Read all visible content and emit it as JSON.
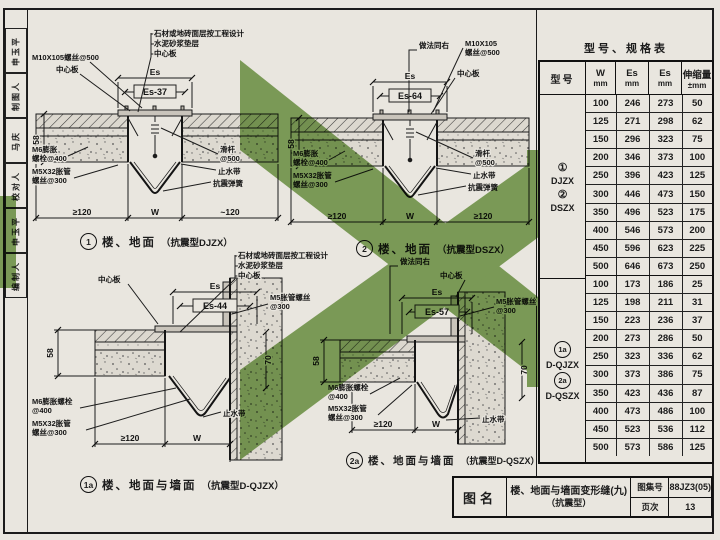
{
  "sheet": {
    "paper": "#e9e6df",
    "ink": "#1c1c1c",
    "green": "#85aa62"
  },
  "sidebar": {
    "cells": [
      "申玉平",
      "制图人",
      "马庆",
      "校对人",
      "申玉平",
      "编制人"
    ]
  },
  "details": {
    "d1": {
      "num": "1",
      "title": "楼、地面",
      "type": "（抗震型DJZX）",
      "es": "Es",
      "es_span": "Es-37",
      "depth": "58",
      "dim_left": "≥120",
      "dim_mid": "W",
      "dim_right": "~120",
      "note_m10": "M10X105螺丝@500",
      "note_center": "中心板",
      "layer1": "石材或地砖面层按工程设计",
      "layer2": "水泥砂浆垫层",
      "layer3": "中心板",
      "note_m6_1": "M6膨胀",
      "note_m6_2": "螺栓@400",
      "note_m5x_1": "M5X32胀管",
      "note_m5x_2": "螺丝@300",
      "note_rod_1": "滑杆",
      "note_rod_2": "@500",
      "note_stop": "止水带",
      "note_spring": "抗震弹簧"
    },
    "d2": {
      "num": "2",
      "title": "楼、地面",
      "type": "（抗震型DSZX）",
      "es": "Es",
      "es_span": "Es-64",
      "depth": "58",
      "dim_left": "≥120",
      "dim_mid": "W",
      "dim_right": "≥120",
      "note_same": "做法同右",
      "note_m10_1": "M10X105",
      "note_m10_2": "螺丝@500",
      "note_center": "中心板",
      "note_m6_1": "M6膨胀",
      "note_m6_2": "螺栓@400",
      "note_m5x_1": "M5X32胀管",
      "note_m5x_2": "螺丝@300",
      "note_rod_1": "滑杆",
      "note_rod_2": "@500",
      "note_stop": "止水带",
      "note_spring": "抗震弹簧"
    },
    "d1a": {
      "num": "1a",
      "title": "楼、地面与墙面",
      "type": "（抗震型D-QJZX）",
      "es": "Es",
      "es_span": "Es-44",
      "depth": "58",
      "wall_dim": "70",
      "dim_left": "≥120",
      "dim_mid": "W",
      "note_center": "中心板",
      "layer1": "石材或地砖面层按工程设计",
      "layer2": "水泥砂浆垫层",
      "layer3": "中心板",
      "note_m5_1": "M5胀管螺丝",
      "note_m5_2": "@300",
      "note_m6_1": "M6膨胀螺栓",
      "note_m6_2": "@400",
      "note_m5x_1": "M5X32胀管",
      "note_m5x_2": "螺丝@300",
      "note_stop": "止水带"
    },
    "d2a": {
      "num": "2a",
      "title": "楼、地面与墙面",
      "type": "（抗震型D-QSZX）",
      "es": "Es",
      "es_span": "Es-57",
      "depth": "58",
      "wall_dim": "70",
      "dim_left": "≥120",
      "dim_mid": "W",
      "note_same": "做法同右",
      "note_center": "中心板",
      "note_m5_1": "M5胀管螺丝",
      "note_m5_2": "@300",
      "note_m6_1": "M6膨胀螺栓",
      "note_m6_2": "@400",
      "note_m5x_1": "M5X32胀管",
      "note_m5x_2": "螺丝@300",
      "note_stop": "止水带"
    }
  },
  "spec_table": {
    "title": "型号、规格表",
    "headers": {
      "model": "型号",
      "w": "W",
      "w_unit": "mm",
      "es1": "Es",
      "es1_unit": "mm",
      "es2": "Es",
      "es2_unit": "mm",
      "range": "伸缩量",
      "range_unit": "±mm"
    },
    "group1": {
      "mark1": "①",
      "name1": "DJZX",
      "mark2": "②",
      "name2": "DSZX",
      "rows": [
        [
          "100",
          "246",
          "273",
          "50"
        ],
        [
          "125",
          "271",
          "298",
          "62"
        ],
        [
          "150",
          "296",
          "323",
          "75"
        ],
        [
          "200",
          "346",
          "373",
          "100"
        ],
        [
          "250",
          "396",
          "423",
          "125"
        ],
        [
          "300",
          "446",
          "473",
          "150"
        ],
        [
          "350",
          "496",
          "523",
          "175"
        ],
        [
          "400",
          "546",
          "573",
          "200"
        ],
        [
          "450",
          "596",
          "623",
          "225"
        ],
        [
          "500",
          "646",
          "673",
          "250"
        ]
      ]
    },
    "group2": {
      "mark1": "1a",
      "name1": "D-QJZX",
      "mark2": "2a",
      "name2": "D-QSZX",
      "rows": [
        [
          "100",
          "173",
          "186",
          "25"
        ],
        [
          "125",
          "198",
          "211",
          "31"
        ],
        [
          "150",
          "223",
          "236",
          "37"
        ],
        [
          "200",
          "273",
          "286",
          "50"
        ],
        [
          "250",
          "323",
          "336",
          "62"
        ],
        [
          "300",
          "373",
          "386",
          "75"
        ],
        [
          "350",
          "423",
          "436",
          "87"
        ],
        [
          "400",
          "473",
          "486",
          "100"
        ],
        [
          "450",
          "523",
          "536",
          "112"
        ],
        [
          "500",
          "573",
          "586",
          "125"
        ]
      ]
    }
  },
  "title_block": {
    "name_label": "图名",
    "title_line1": "楼、地面与墙面变形缝(九)",
    "title_line2": "（抗震型）",
    "atlas_label": "图集号",
    "atlas_no": "88JZ3(05)",
    "page_label": "页次",
    "page_no": "13"
  }
}
